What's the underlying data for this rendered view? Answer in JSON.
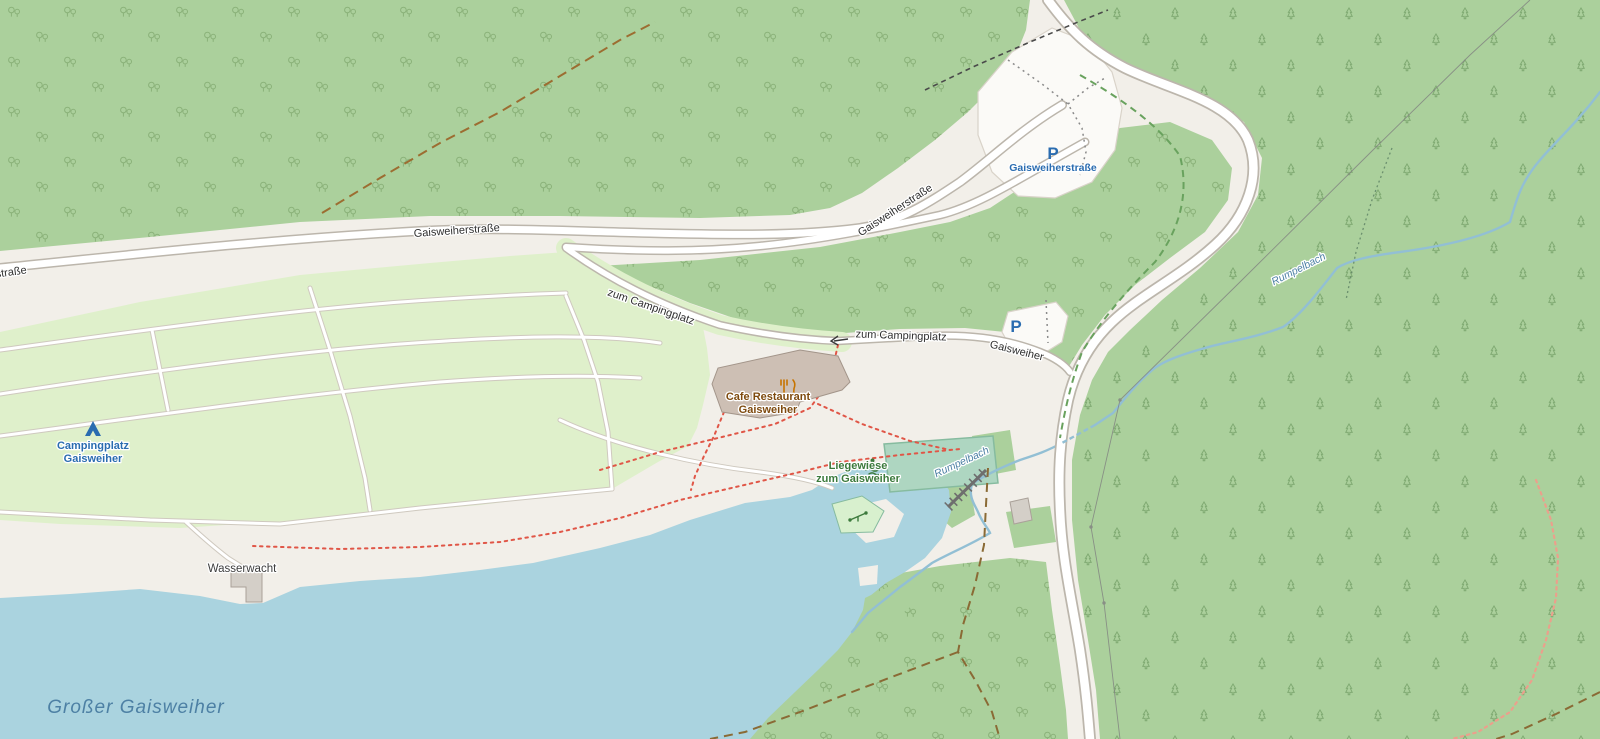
{
  "map": {
    "labels": {
      "road_gaisweiherstrasse": "Gaisweiherstraße",
      "road_zum_campingplatz": "zum Campingplatz",
      "road_gaisweiher": "Gaisweiher",
      "parking_symbol": "P",
      "parking_name": "Gaisweiherstraße",
      "campsite_line1": "Campingplatz",
      "campsite_line2": "Gaisweiher",
      "restaurant_line1": "Cafe Restaurant",
      "restaurant_line2": "Gaisweiher",
      "meadow_line1": "Liegewiese",
      "meadow_line2": "zum Gaisweiher",
      "water_rescue": "Wasserwacht",
      "lake": "Großer Gaisweiher",
      "stream": "Rumpelbach"
    },
    "icons": {
      "campsite": "tent-icon",
      "restaurant": "fork-knife-icon",
      "meadow": "swimmer-icon",
      "playground": "playground-icon",
      "parking": "parking-icon",
      "gate": "gate-arrow-icon"
    },
    "colors": {
      "land": "#f2efe9",
      "forest": "#abd09c",
      "tree_decid": "#7ca56b",
      "tree_conif": "#6f9c63",
      "water": "#aad3df",
      "stream": "#92bfd4",
      "camp": "#dff0cb",
      "road_fill": "#ffffff",
      "road_casing": "#bcb6ac",
      "building": "#cdbfb4",
      "building_stroke": "#a3958a",
      "parking_fill": "#fbfaf7",
      "parking_blue": "#2a6cb0",
      "label_road": "#2f2f2f",
      "label_water": "#4d80a4",
      "label_amenity": "#7e4a0e",
      "label_leisure": "#3c7a3c",
      "trail_red": "#e05647",
      "trail_brown": "#9c6d31",
      "trail_green": "#69a25e",
      "trail_pink": "#eba08c",
      "pitch": "#aed6c1",
      "playground": "#d8f0ce",
      "dam": "#6e6e6e"
    }
  }
}
